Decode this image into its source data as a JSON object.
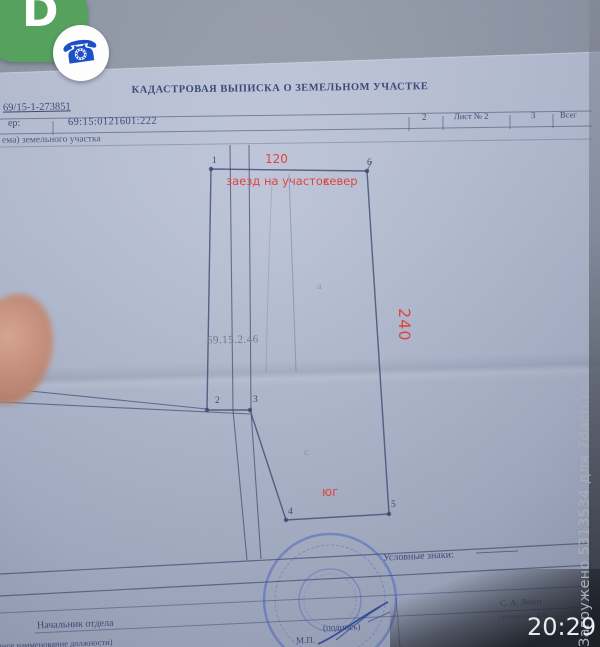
{
  "overlay": {
    "app_bubble_letter": "D",
    "phone_glyph": "☎",
    "clock": "20:29",
    "watermark": "Загружено 5313534 для 7dach.ru"
  },
  "document": {
    "title": "КАДАСТРОВАЯ ВЫПИСКА О ЗЕМЕЛЬНОМ УЧАСТКЕ",
    "doc_number": "69/15-1-273851",
    "header_row": {
      "label_fragment": "ер:",
      "cadastral_number": "69:15:0121601:222",
      "col_a": "2",
      "col_sheet": "Лист № 2",
      "col_b": "3",
      "col_total_fragment": "Всег"
    },
    "section_caption_fragment": "ема) земельного участка",
    "legend_label": "Условные знаки:",
    "footer": {
      "officer_title": "Начальник отдела",
      "officer_title_caption": "(полное наименование должности)",
      "signature_caption": "(подпись)",
      "officer_name": "С. А. Леонт",
      "name_caption": "(инициалы, фам",
      "stamp_caption": "М.П."
    }
  },
  "diagram": {
    "parcel_number": "69.15.2.46",
    "points": [
      "1",
      "2",
      "3",
      "4",
      "5",
      "6"
    ],
    "annotations": {
      "top_width": "120",
      "right_length": "240",
      "entrance": "заезд на участок",
      "north": "север",
      "south": "юг"
    },
    "pencil_marks": [
      "а",
      "с"
    ],
    "colors": {
      "annotation_red": "#e0453e",
      "ink_blue": "#3d4a72",
      "stamp_blue": "#2f4fbf"
    }
  }
}
